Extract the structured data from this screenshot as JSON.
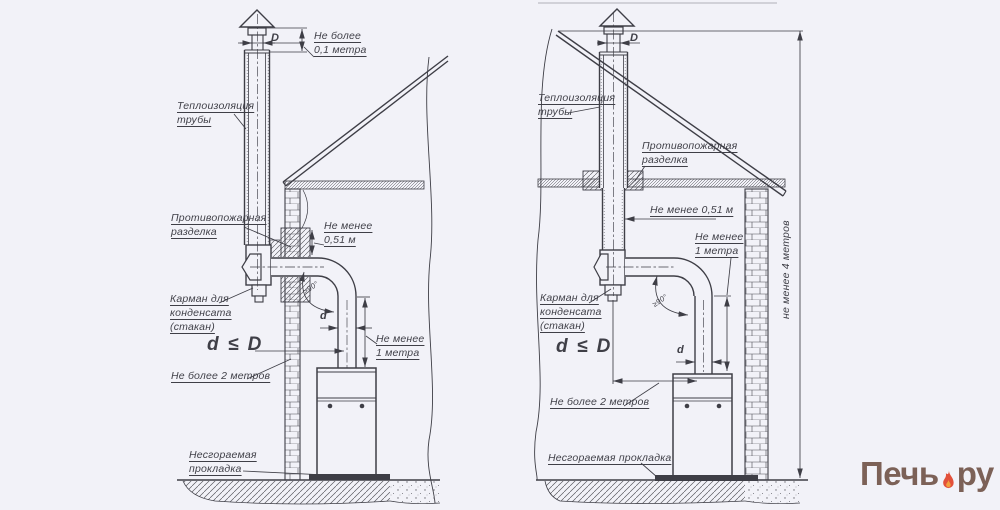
{
  "colors": {
    "background": "#f2f2f8",
    "line": "#3e3e46",
    "text": "#3f3f47"
  },
  "left": {
    "labels": {
      "top_clearance": "Не более\n0,1 метра",
      "diameter": "D",
      "insulation": "Теплоизоляция\nтрубы",
      "fire_cut": "Противопожарная\nразделка",
      "min_gap": "Не менее\n0,51 м",
      "pocket": "Карман для\nконденсата\n(стакан)",
      "formula": "d ≤ D",
      "max_run": "Не более 2 метров",
      "small_d": "d",
      "min_vertical": "Не менее\n1 метра",
      "pad": "Несгораемая\nпрокладка",
      "angle": "≥90°"
    }
  },
  "right": {
    "labels": {
      "diameter": "D",
      "insulation": "Теплоизоляция\nтрубы",
      "fire_cut": "Противопожарная\nразделка",
      "min_gap": "Не менее 0,51 м",
      "min_vertical": "Не менее\n1 метра",
      "pocket": "Карман для\nконденсата\n(стакан)",
      "formula": "d ≤ D",
      "small_d": "d",
      "max_run": "Не более 2 метров",
      "pad": "Несгораемая прокладка",
      "min_height": "не менее 4 метров",
      "angle": "≥90°"
    }
  },
  "watermark": {
    "name_part1": "Печь",
    "name_part2": "ру",
    "icon": "flame-icon",
    "text_color": "#7c6157",
    "flame_color": "#e2503a"
  }
}
